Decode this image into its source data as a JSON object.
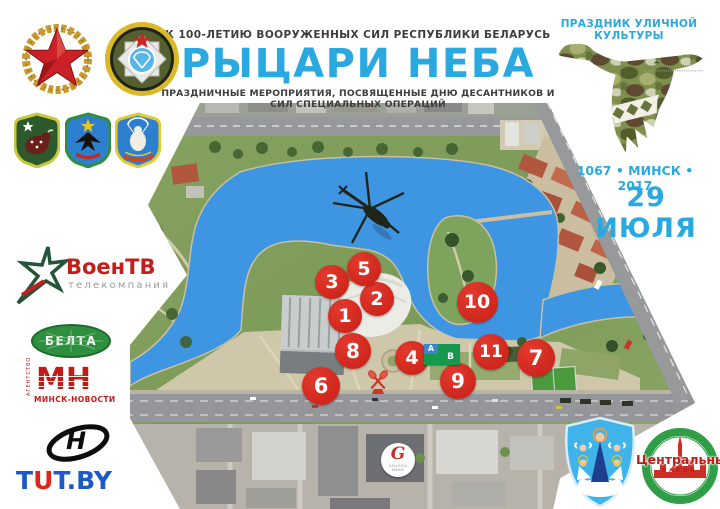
{
  "header": {
    "kicker": "К 100-ЛЕТИЮ ВООРУЖЕННЫХ СИЛ РЕСПУБЛИКИ БЕЛАРУСЬ",
    "title": "РЫЦАРИ НЕБА",
    "subtitle": "ПРАЗДНИЧНЫЕ МЕРОПРИЯТИЯ,  ПОСВЯЩЕННЫЕ  ДНЮ ДЕСАНТНИКОВ И СИЛ СПЕЦИАЛЬНЫХ ОПЕРАЦИЙ",
    "accent_color": "#2aa9e1"
  },
  "right_panel": {
    "kicker": "ПРАЗДНИК УЛИЧНОЙ КУЛЬТУРЫ",
    "stork_icon": "camouflage-stork",
    "city_line": "1067 • МИНСК • 2017",
    "date": "29 ИЮЛЯ"
  },
  "left_logos": {
    "army_emblem_icon": "red-star-laurel-wreath-emblem",
    "sof_emblem_icon": "special-operations-forces-roundel",
    "patch_icons": [
      "green-shield-bison-patch",
      "blue-shield-eagle-patch",
      "blue-shield-bird-parachute-patch"
    ],
    "voentv": {
      "name": "ВоенТВ",
      "tagline": "телекомпания",
      "star_icon": "green-star-outline"
    },
    "belta": {
      "label": "БЕЛТА"
    },
    "mn": {
      "vertical": "АГЕНТСТВО",
      "abbr": "МН",
      "subtitle": "МИНСК-НОВОСТИ"
    },
    "n_logo": {
      "letter": "Н"
    },
    "tutby": {
      "t1": "T",
      "u": "U",
      "t2": "T",
      "tail": ".BY"
    }
  },
  "bottom_right": {
    "minsk_arms_icon": "minsk-coat-of-arms",
    "central": {
      "name": "Центральный",
      "district": "РАЙОН"
    }
  },
  "map": {
    "helicopter_icon": "helicopter-silhouette",
    "paddles_icon": "crossed-red-paddles",
    "markers": [
      {
        "label": "1",
        "x": 345,
        "y": 316,
        "size": 34
      },
      {
        "label": "2",
        "x": 377,
        "y": 299,
        "size": 34
      },
      {
        "label": "3",
        "x": 332,
        "y": 282,
        "size": 34
      },
      {
        "label": "4",
        "x": 412,
        "y": 358,
        "size": 34
      },
      {
        "label": "5",
        "x": 364,
        "y": 269,
        "size": 34
      },
      {
        "label": "6",
        "x": 321,
        "y": 386,
        "size": 38
      },
      {
        "label": "7",
        "x": 536,
        "y": 358,
        "size": 38
      },
      {
        "label": "8",
        "x": 353,
        "y": 351,
        "size": 36
      },
      {
        "label": "9",
        "x": 458,
        "y": 381,
        "size": 36
      },
      {
        "label": "10",
        "x": 477,
        "y": 302,
        "size": 41
      },
      {
        "label": "11",
        "x": 491,
        "y": 352,
        "size": 36
      }
    ],
    "stages": {
      "a": "А",
      "b": "В"
    },
    "galleria": {
      "letter": "G",
      "line1": "GALLERIA",
      "line2": "MINSK"
    }
  }
}
